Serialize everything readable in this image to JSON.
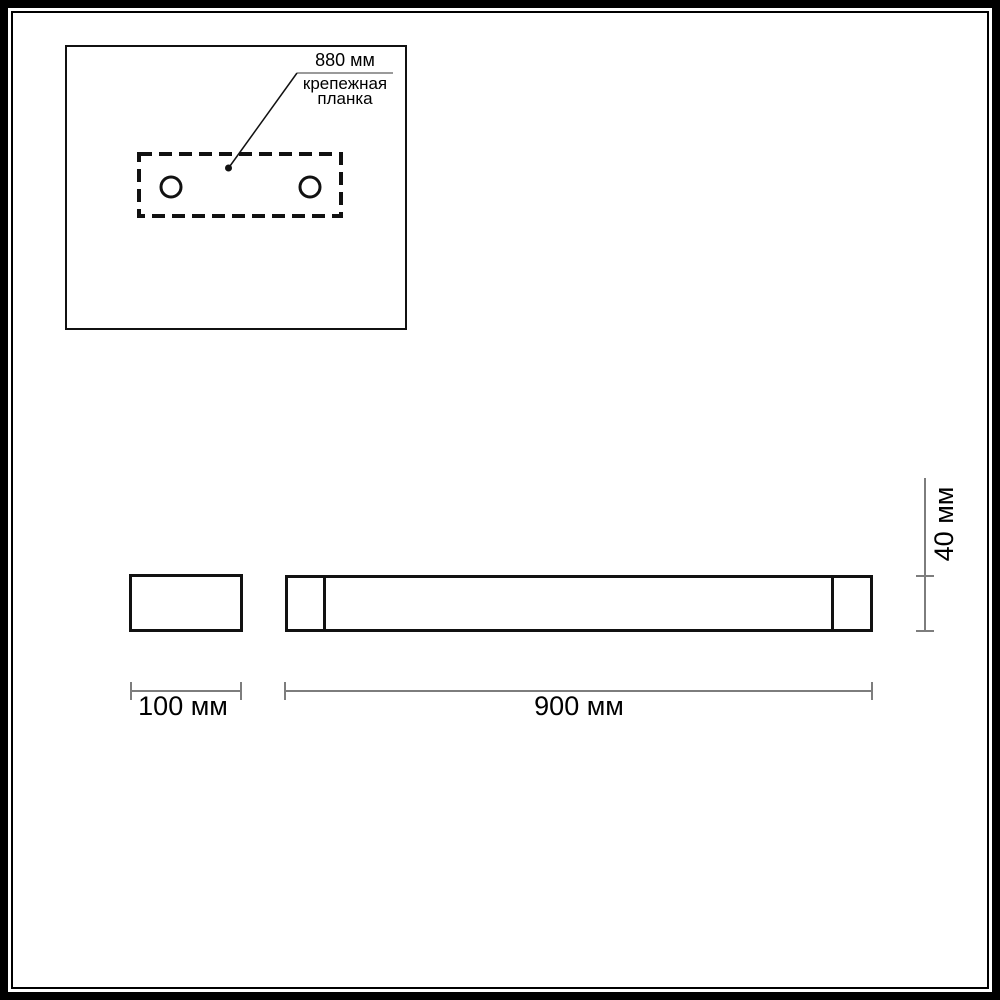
{
  "inset": {
    "dim_label": "880 мм",
    "caption_line1": "крепежная",
    "caption_line2": "планка"
  },
  "dimensions": {
    "small_width": "100 мм",
    "large_width": "900 мм",
    "height": "40 мм"
  },
  "colors": {
    "line": "#111111",
    "dim_line": "#7d7d7d",
    "underline": "#9a9a9a",
    "text": "#000000",
    "background": "#ffffff"
  }
}
